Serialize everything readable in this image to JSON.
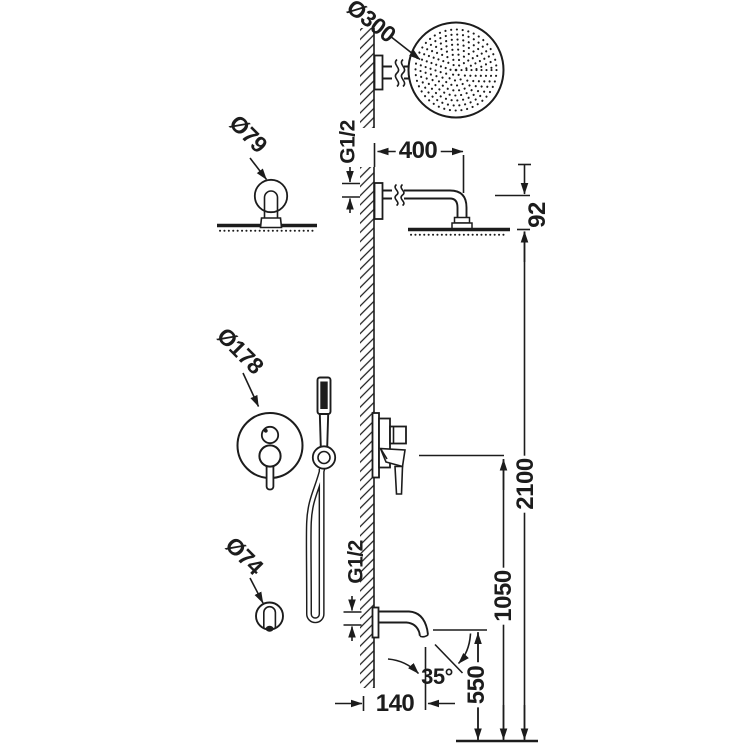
{
  "labels": {
    "head_diameter": "Ø300",
    "arm_flange_diameter": "Ø79",
    "thread_top": "G1/2",
    "arm_length": "400",
    "head_drop": "92",
    "mixer_plate_diameter": "Ø178",
    "spout_flange_diameter": "Ø74",
    "thread_bottom": "G1/2",
    "spout_reach": "140",
    "spout_angle": "35°",
    "spout_height": "550",
    "mixer_height": "1050",
    "overall_height": "2100"
  },
  "colors": {
    "line": "#1c1c1c",
    "background": "#ffffff"
  }
}
